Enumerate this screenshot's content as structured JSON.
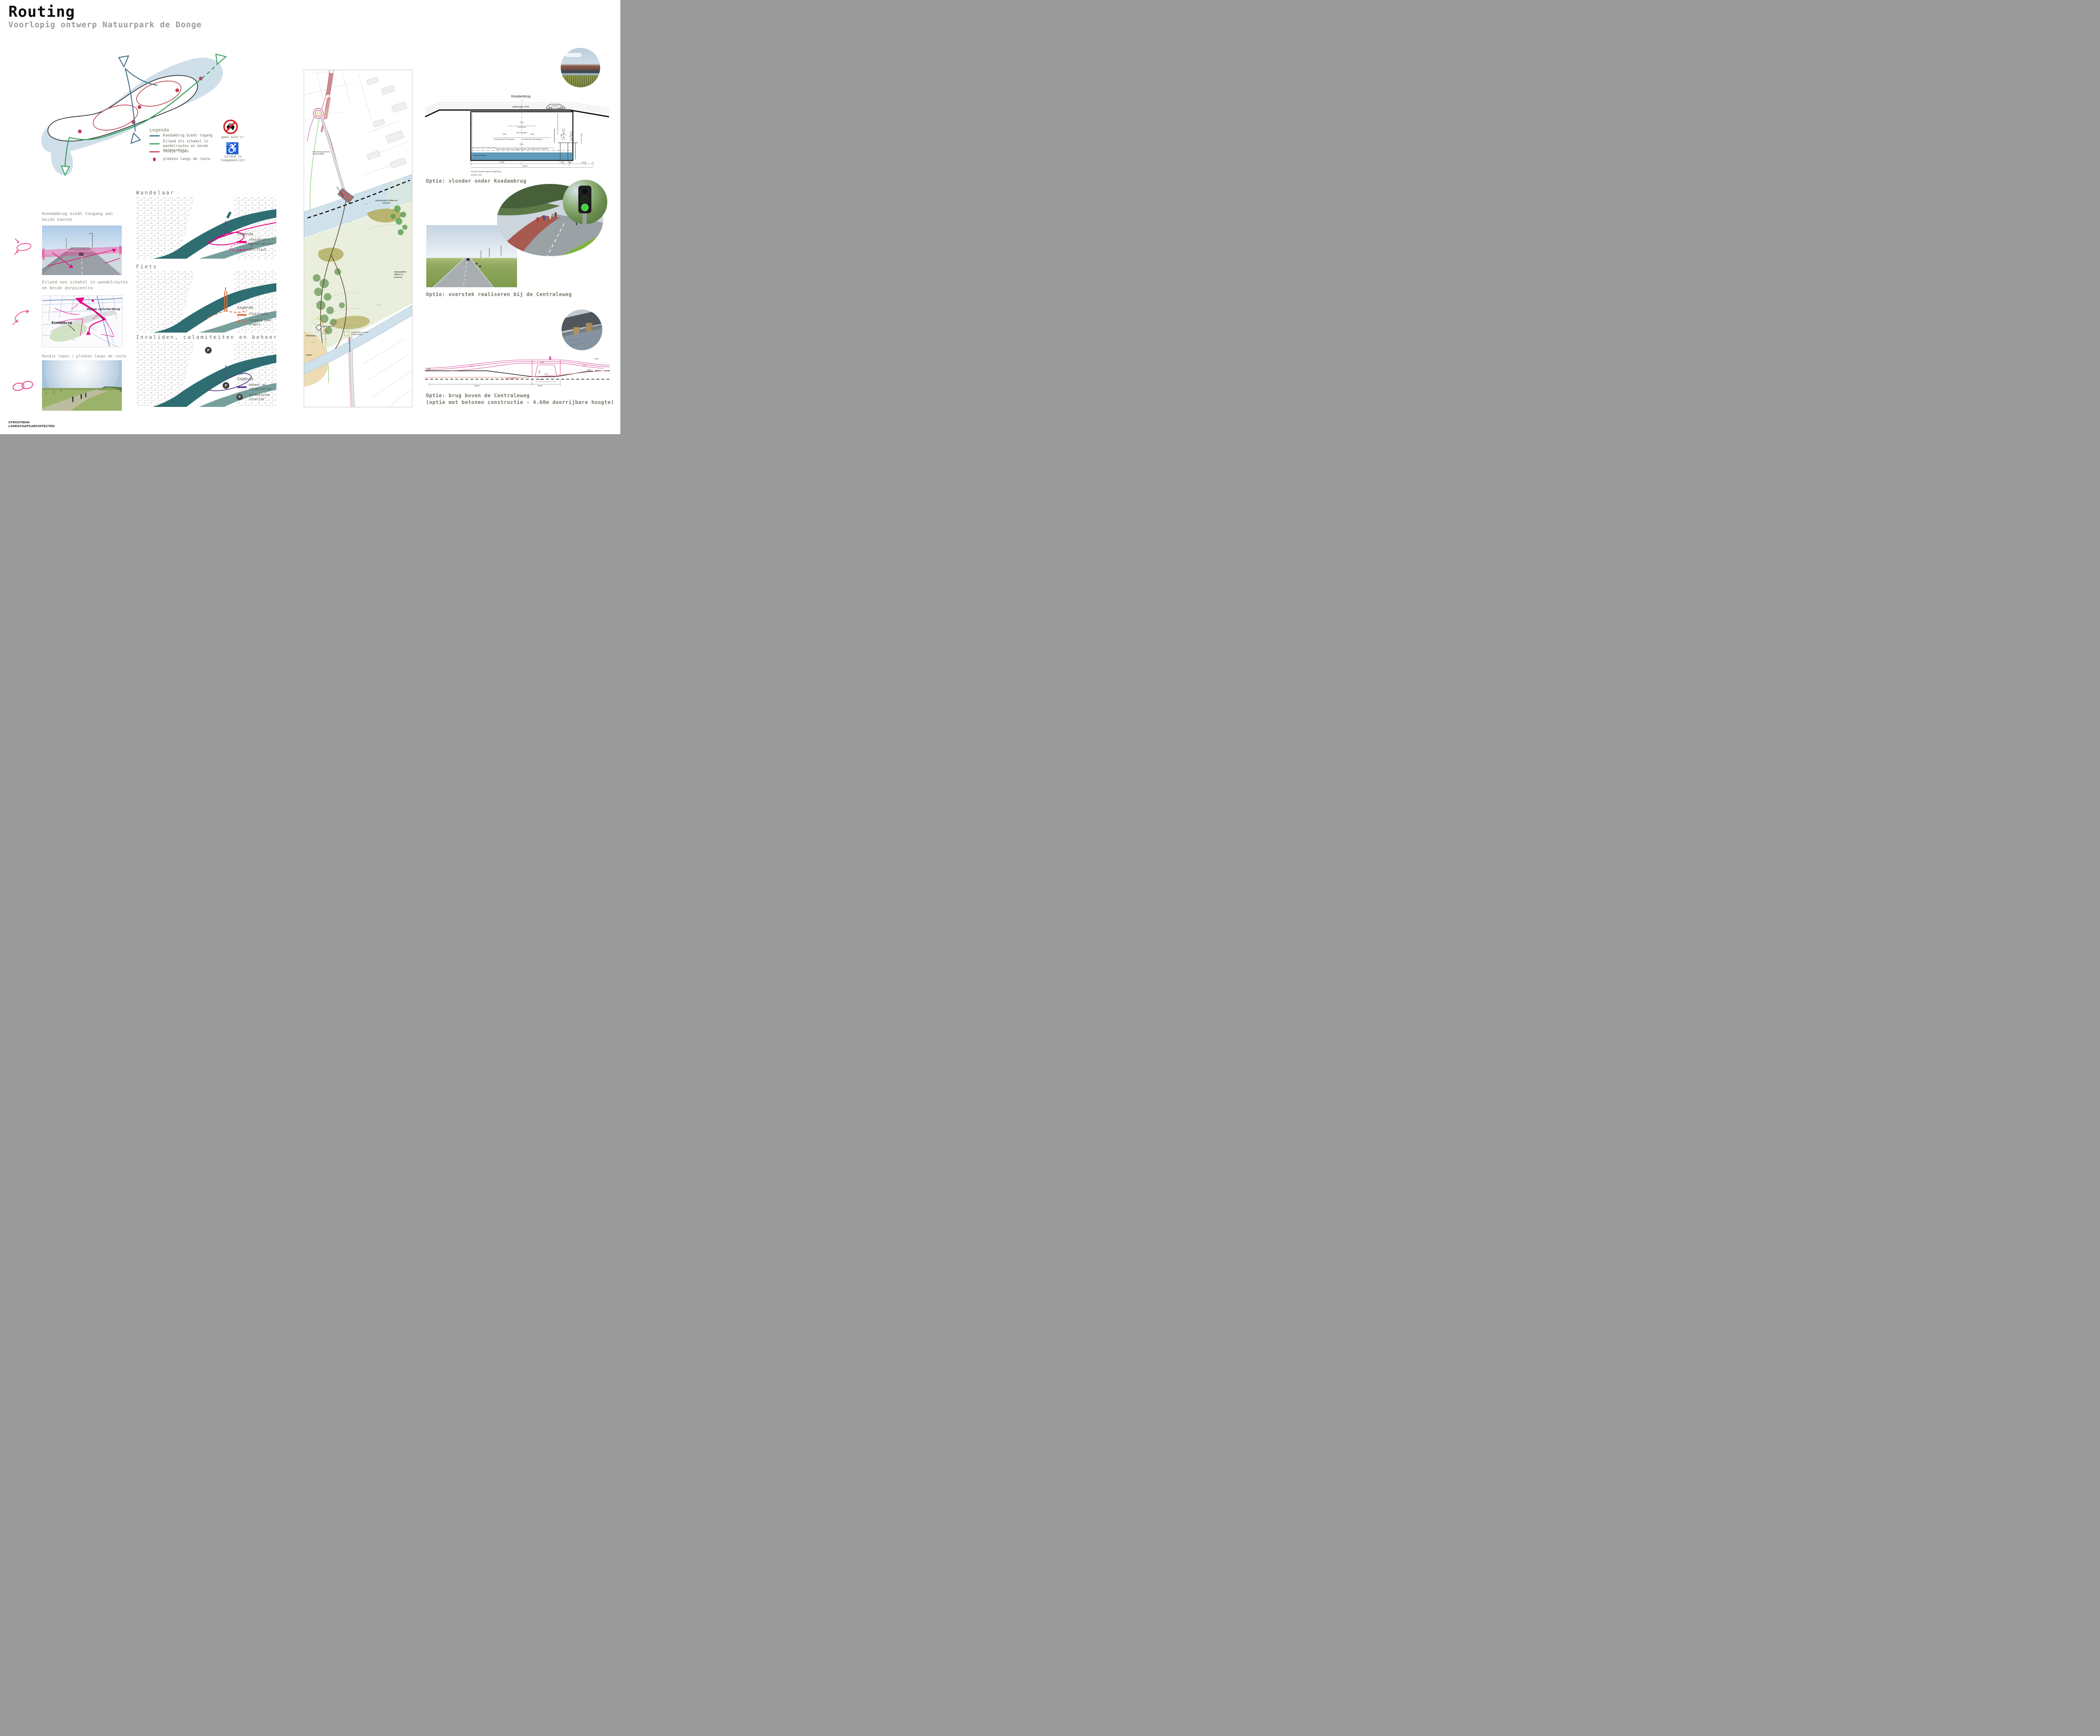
{
  "header": {
    "title": "Routing",
    "subtitle": "Voorlopig ontwerp Natuurpark de Donge"
  },
  "concept_legend": {
    "title": "Legenda",
    "item_bridge": "Koedambrug biedt togang",
    "item_island": "Eiland als schakel in wandelroutes en beide dorpscentra",
    "item_loop": "rondje lopen",
    "item_spots": "plekken langs de route",
    "no_cars": "geen auto's!",
    "accessible": "eiland is toegankelijk!"
  },
  "left": {
    "s1_title": "Koedambrug biedt toegang aan beide kanten",
    "s2_title": "Eiland een schakel in wandelroutes en beide dorpscentra",
    "s3_title": "Rondje lopen / plekken langs de route",
    "map_koedambrug": "Koedambrug",
    "map_letschertbrug": "Willem Letschertbrug",
    "map_15": "15 mins",
    "map_10": "10 mins"
  },
  "middle": {
    "wandelaar": {
      "heading": "Wandelaar",
      "legend_title": "Legenda",
      "l1": "voetgangers + mindervaliden",
      "l2": "off-track"
    },
    "fiets": {
      "heading": "Fiets",
      "legend_title": "Legenda",
      "l1": "fietsroute",
      "l2": "toegang naar plaats"
    },
    "invaliden": {
      "heading": "Invaliden, calamiteiten en beheer",
      "legend_title": "Legenda",
      "l1": "beheer en calamiteiten",
      "l2": "parkeerplek invalide",
      "p": "P"
    }
  },
  "plan": {
    "reservering_top": "reservering parkeren mindervaliden",
    "centraleweg": "Centraleweg",
    "natuurgebied_a": "natuurgebied slikken en schorren",
    "natuurgebied_b": "natuurgebied slikken en schorren",
    "monnikenweg": "Monnikenweg",
    "kiosk": "kiosk fase 2",
    "fietsnietjes": "fietsnietjes",
    "strand": "strand",
    "reservering_bottom": "reservering parkeren mindervaliden",
    "c300": "+3.00",
    "c350": "+3.50",
    "c250": "+2.50",
    "c200": "+2.00",
    "c150": "+1.50",
    "c100": "+1.00"
  },
  "vlonder": {
    "title": "Koedambrug",
    "dekhoogte": "dekhoogte: 6.50",
    "dim_558": "5,58",
    "dim_420": "4,20",
    "bunkerboot": "bunkerboot",
    "twee_lichtingen": "twee lichtingen",
    "dim_450_l": "4,50",
    "dim_450_r": "4,50",
    "recreatievaart_l": "recreatievaart BM categorie",
    "recreatievaart_r": "recreatievaart BM categorie",
    "dim_904": "9,04",
    "baggerschip": "Reservering ruimte voor baggerschip type: KRAANSCHIP GOUWZEE",
    "bescherming": "bescherming van de vlonder - n.t.b.",
    "fauna": "fauna passage",
    "dim_130": "1,30",
    "waterniveau": "gemiddelde waterniveau +0.40",
    "diepte": "diepte onbekend",
    "dim_1500": "15,00",
    "dim_100_a": "1,00",
    "dim_300": "3,00",
    "dim_100_b": "1,00",
    "dim_2000": "20,00",
    "caption_line1": "Principe vlonder onder Koedambrug",
    "caption_line2": "schaal 1:100",
    "option": "Optie: vlonder onder Koedambrug"
  },
  "overstek": {
    "option": "Optie: overstek realiseren bij de Centraleweg"
  },
  "brug": {
    "pct_left": "4%",
    "pct_right": "4%",
    "dim_380_l": "3.80",
    "dim_660": "6.60",
    "dim_580": "5.80",
    "dim_380_r": "3.80",
    "dim_460": "4.60",
    "dim_110": "1.10",
    "dim_785": "7,85",
    "dim_1305": "13,05",
    "dim_5000": "50,00",
    "option_line1": "Optie: brug boven de Centraleweg",
    "option_line2": "(optie met betonen constructie - 4.60m doorrijbare hoogte)"
  },
  "footer": {
    "line1": "STROOTMAN",
    "line2": "LANDSCHAPSARCHITECTEN"
  }
}
